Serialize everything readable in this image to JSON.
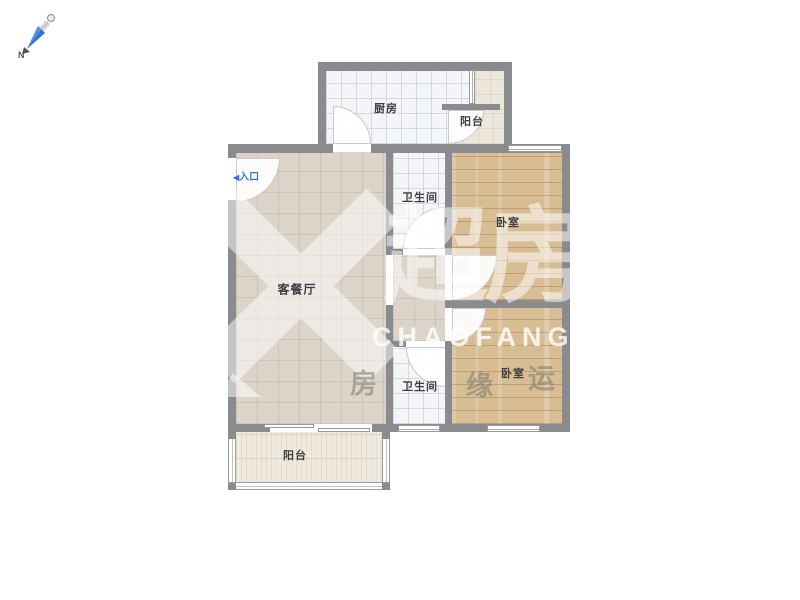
{
  "compass": {
    "north_label": "N"
  },
  "entry": {
    "marker": "◀",
    "label": "入口"
  },
  "rooms": {
    "kitchen": {
      "label": "厨房"
    },
    "balcony_top": {
      "label": "阳台"
    },
    "bathroom_top": {
      "label": "卫生间"
    },
    "bedroom_top": {
      "label": "卧室"
    },
    "living_dining": {
      "label": "客餐厅"
    },
    "bathroom_bottom": {
      "label": "卫生间"
    },
    "bedroom_bottom": {
      "label": "卧室"
    },
    "balcony_bottom": {
      "label": "阳台"
    }
  },
  "watermark": {
    "brand_cn": "超房",
    "brand_en": "CHAOFANG",
    "slogan": [
      "房",
      "缘",
      "运"
    ]
  },
  "colors": {
    "wall": "#8a8b8f",
    "living_floor": "#dcd4c9",
    "wood_floor": "#d8bd94",
    "tile_floor": "#f4f5f7",
    "balcony_floor": "#ece7db",
    "entry_accent": "#3478cf",
    "compass_needle": "#2f6fd6",
    "watermark_white": "#ffffff"
  }
}
